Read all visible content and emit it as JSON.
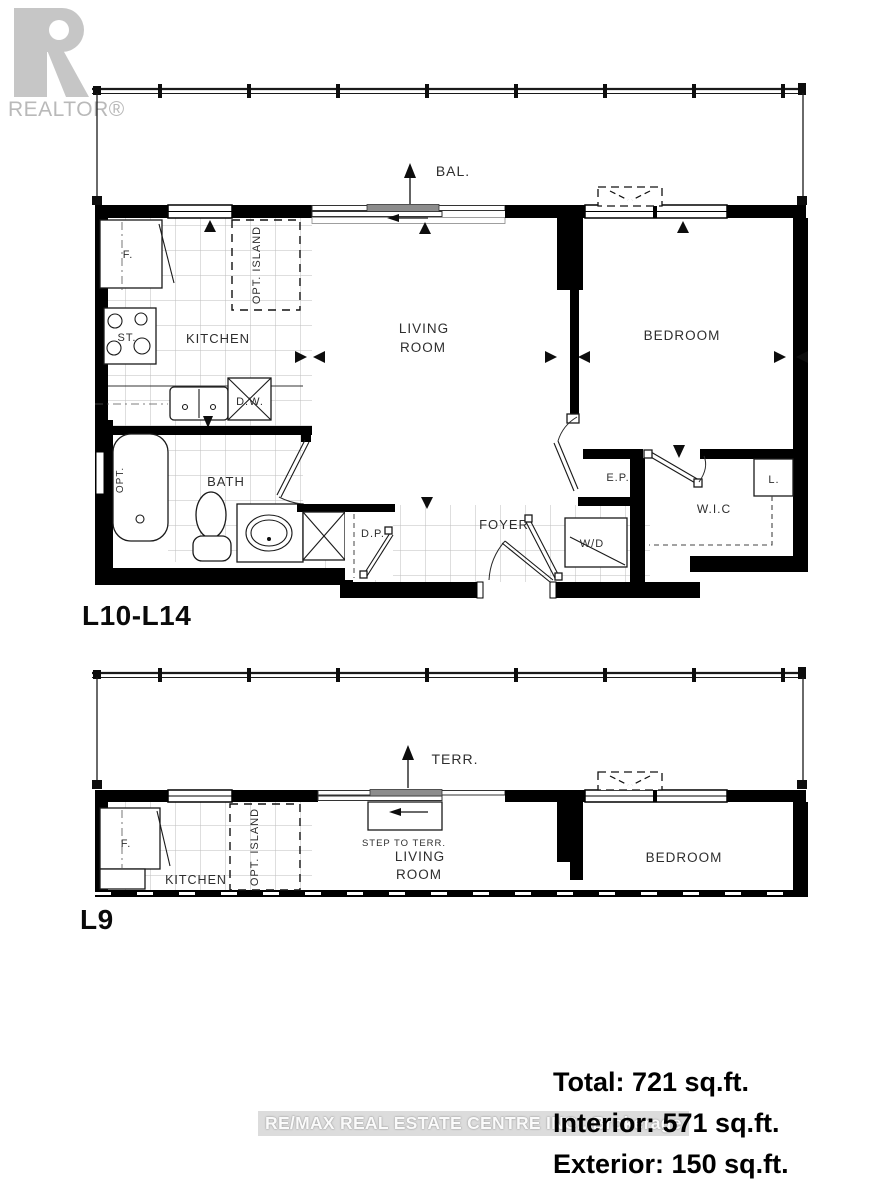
{
  "branding": {
    "logo_text": "REALTOR®",
    "watermark": "RE/MAX REAL ESTATE CENTRE INC., Brokerage"
  },
  "upper_plan": {
    "floor_label": "L10-L14",
    "balcony": "BAL.",
    "kitchen": "KITCHEN",
    "living_line1": "LIVING",
    "living_line2": "ROOM",
    "bedroom": "BEDROOM",
    "bath": "BATH",
    "foyer": "FOYER",
    "wic": "W.I.C",
    "fridge": "F.",
    "stove": "ST.",
    "dishwasher": "D.W.",
    "opt_island": "OPT. ISLAND",
    "tub": "OPT.",
    "washer_dryer": "W/D",
    "elec_panel": "E.P.",
    "closet": "D.P.",
    "linen": "L."
  },
  "lower_plan": {
    "floor_label": "L9",
    "terrace": "TERR.",
    "step": "STEP TO TERR.",
    "kitchen": "KITCHEN",
    "living_line1": "LIVING",
    "living_line2": "ROOM",
    "bedroom": "BEDROOM",
    "fridge": "F.",
    "opt_island": "OPT. ISLAND"
  },
  "area_summary": {
    "total": "Total: 721 sq.ft.",
    "interior": "Interior: 571 sq.ft.",
    "exterior": "Exterior: 150 sq.ft."
  },
  "colors": {
    "wall": "#000000",
    "label_text": "#2e2e2e",
    "tile_grid": "#bdbdbd",
    "logo_gray": "#c6c6c6",
    "watermark_bg": "#dcdcdc",
    "watermark_text": "#fafafa"
  }
}
